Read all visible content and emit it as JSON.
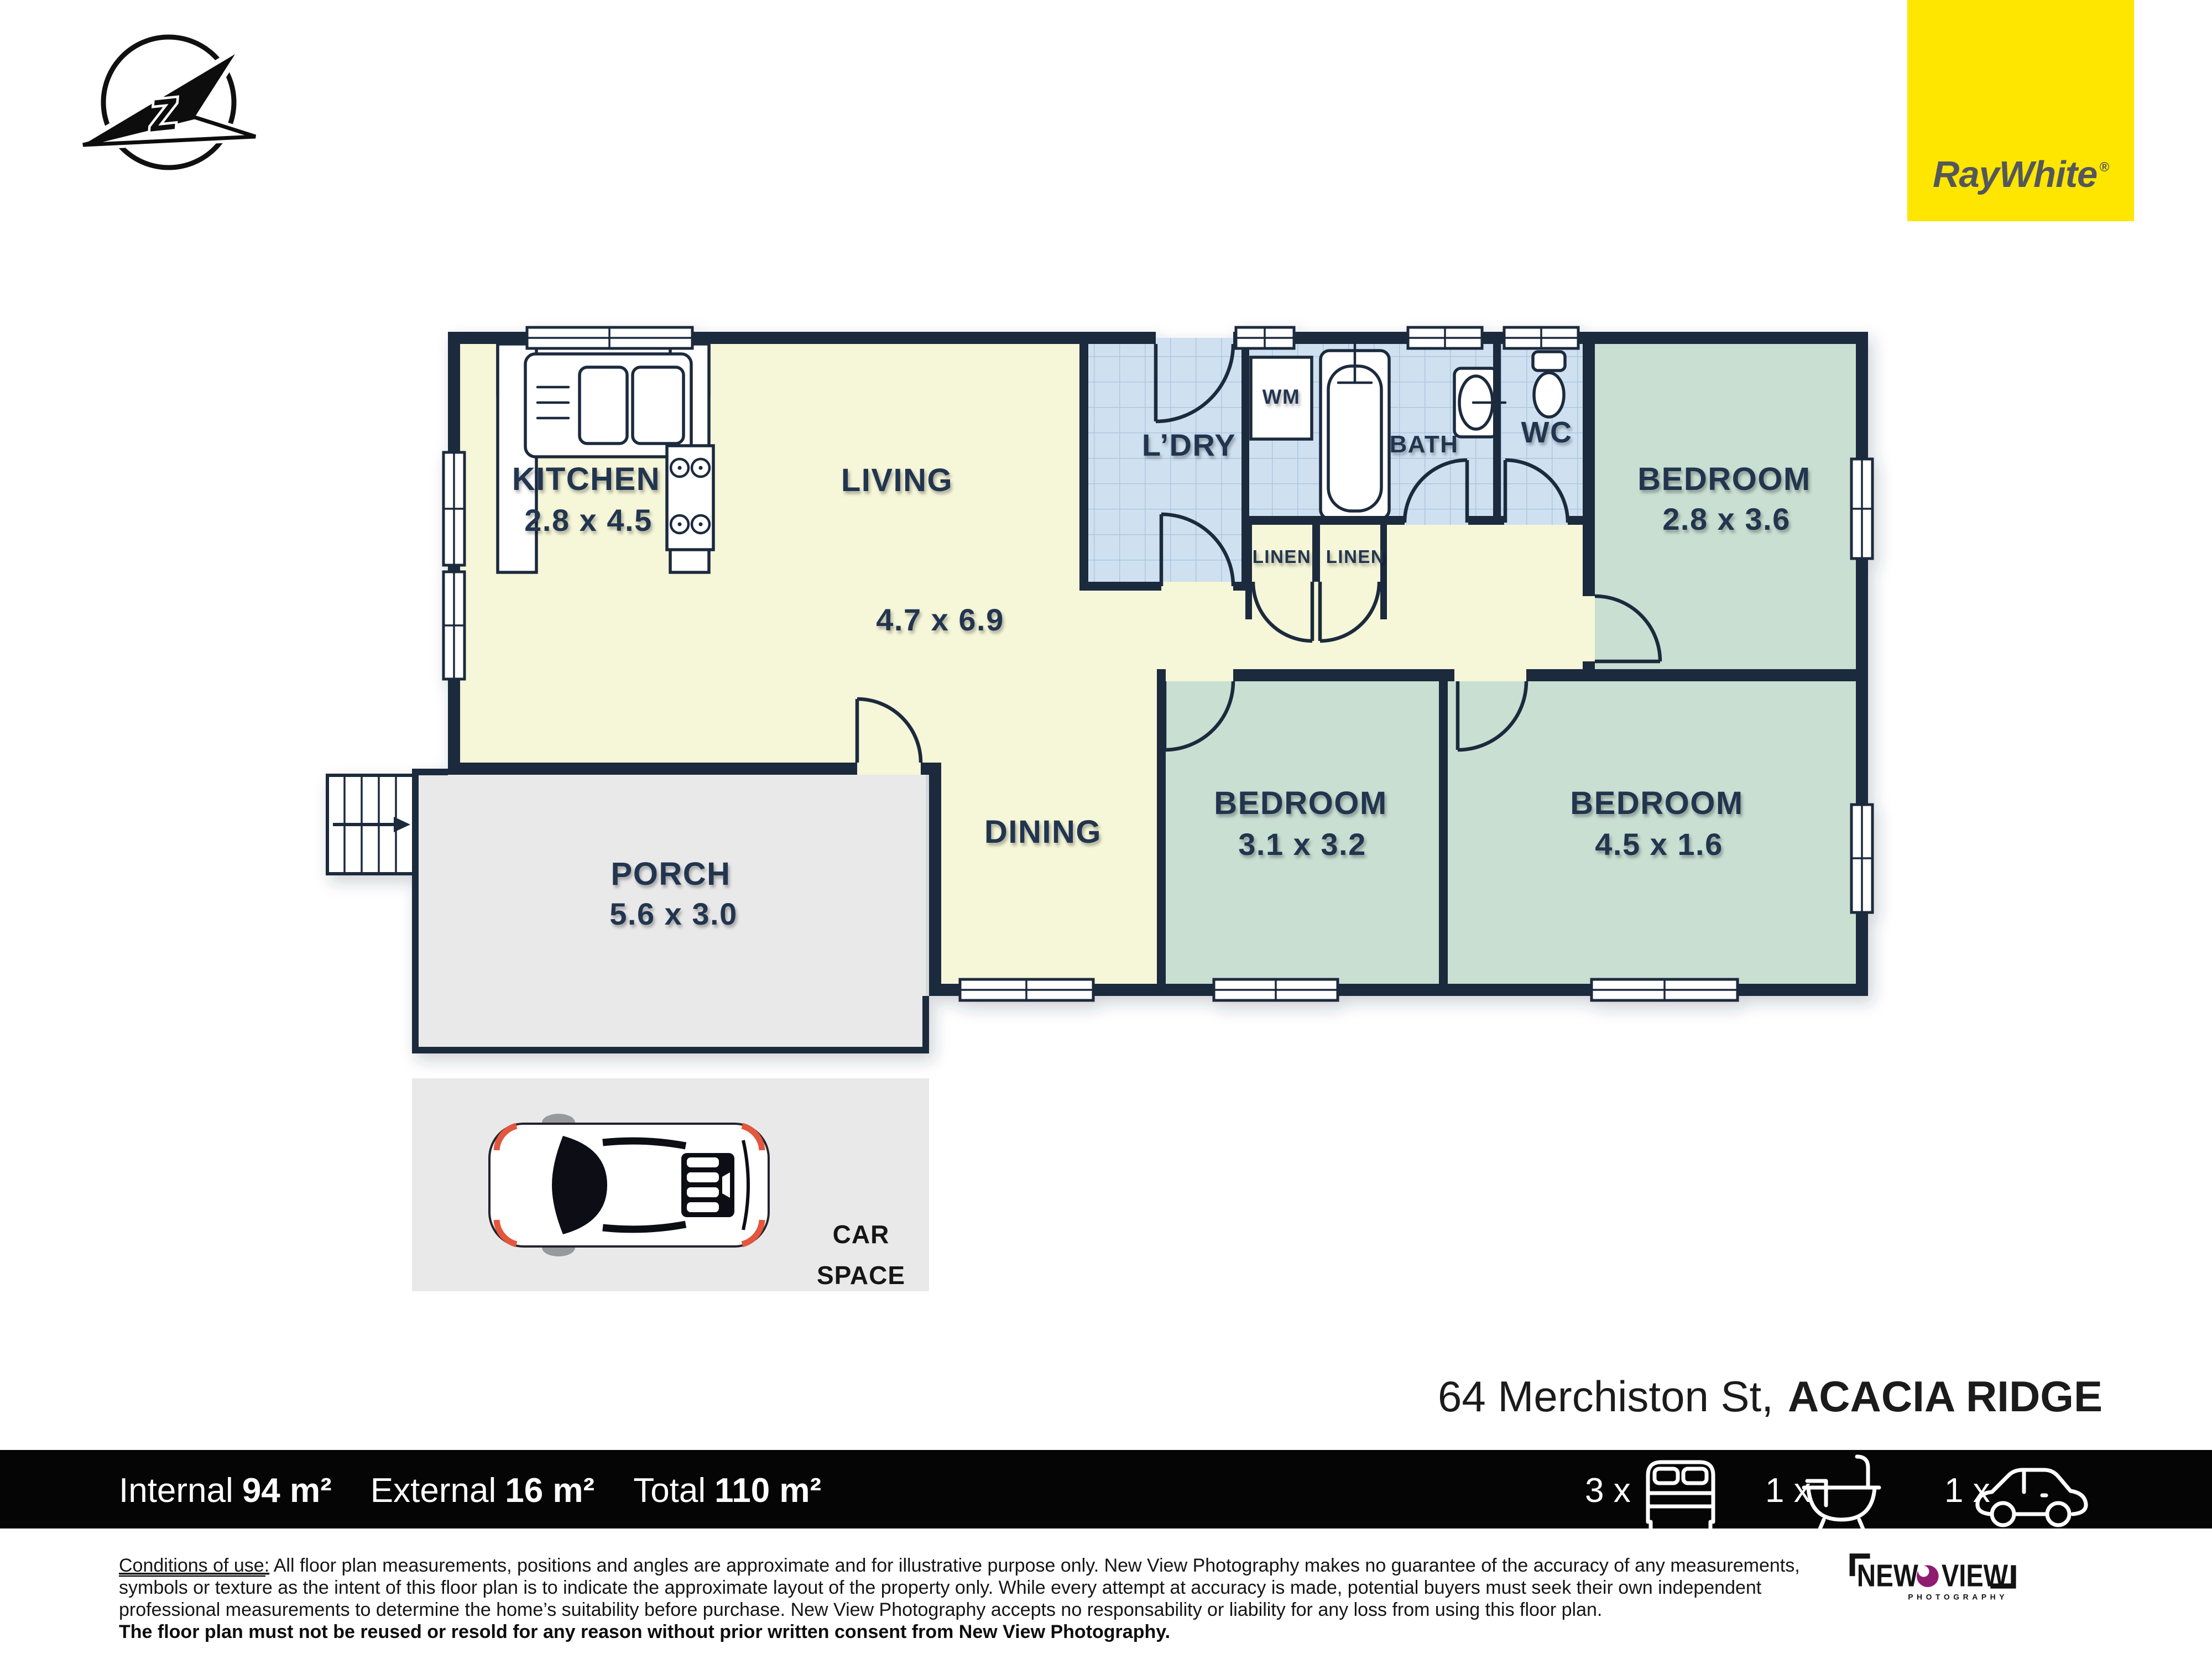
{
  "branding": {
    "ray_white": "RayWhite",
    "registered": "®",
    "brand_yellow": "#FFE600",
    "logo_text_color": "#54585B",
    "new_view": {
      "word1": "NEW",
      "word2": "VIEW",
      "subtitle": "PHOTOGRAPHY",
      "lens_purple": "#8E1C6F"
    }
  },
  "compass": {
    "letter": "Z"
  },
  "rooms": {
    "kitchen": {
      "name": "KITCHEN",
      "dims": "2.8 x 4.5"
    },
    "living": {
      "name": "LIVING",
      "dims": "4.7 x 6.9"
    },
    "laundry": {
      "name": "L’DRY"
    },
    "wm": {
      "name": "WM"
    },
    "bath": {
      "name": "BATH"
    },
    "wc": {
      "name": "WC"
    },
    "linen1": {
      "name": "LINEN"
    },
    "linen2": {
      "name": "LINEN"
    },
    "bedroom1": {
      "name": "BEDROOM",
      "dims": "2.8 x 3.6"
    },
    "dining": {
      "name": "DINING"
    },
    "bedroom2": {
      "name": "BEDROOM",
      "dims": "3.1 x 3.2"
    },
    "bedroom3": {
      "name": "BEDROOM",
      "dims": "4.5 x 1.6"
    },
    "porch": {
      "name": "PORCH",
      "dims": "5.6 x 3.0"
    },
    "car_space": {
      "line1": "CAR",
      "line2": "SPACE"
    }
  },
  "address": {
    "street": "64 Merchiston St,",
    "suburb": "ACACIA RIDGE"
  },
  "summary": {
    "internal_label": "Internal",
    "internal_value": "94 m²",
    "external_label": "External",
    "external_value": "16 m²",
    "total_label": "Total",
    "total_value": "110 m²"
  },
  "counts": {
    "beds": "3 x",
    "baths": "1 x",
    "cars": "1 x"
  },
  "disclaimer": {
    "title": "Conditions of use:",
    "line1": " All floor plan measurements, positions and angles are approximate and for illustrative purpose only. New View Photography makes no guarantee of the accuracy of any measurements,",
    "line2": "symbols or texture as the intent of this floor plan is to indicate the approximate layout of the property only. While every attempt at accuracy is made, potential buyers must seek their own independent",
    "line3": "professional measurements to determine the home’s suitability before purchase. New View Photography accepts no responsability or liability for any loss from using this floor plan.",
    "line4": "The floor plan must not be reused or resold for any reason without prior written consent from New View Photography."
  },
  "colors": {
    "wall_navy": "#1c2b3e",
    "floor_living_yellow": "#f6f6d8",
    "floor_bedroom_green": "#c9dfd2",
    "wet_area_tile_blue": "#cfe1f1",
    "porch_gray": "#e9e9e9",
    "summary_bar_black": "#050505",
    "car_accent_red": "#E2573D"
  }
}
